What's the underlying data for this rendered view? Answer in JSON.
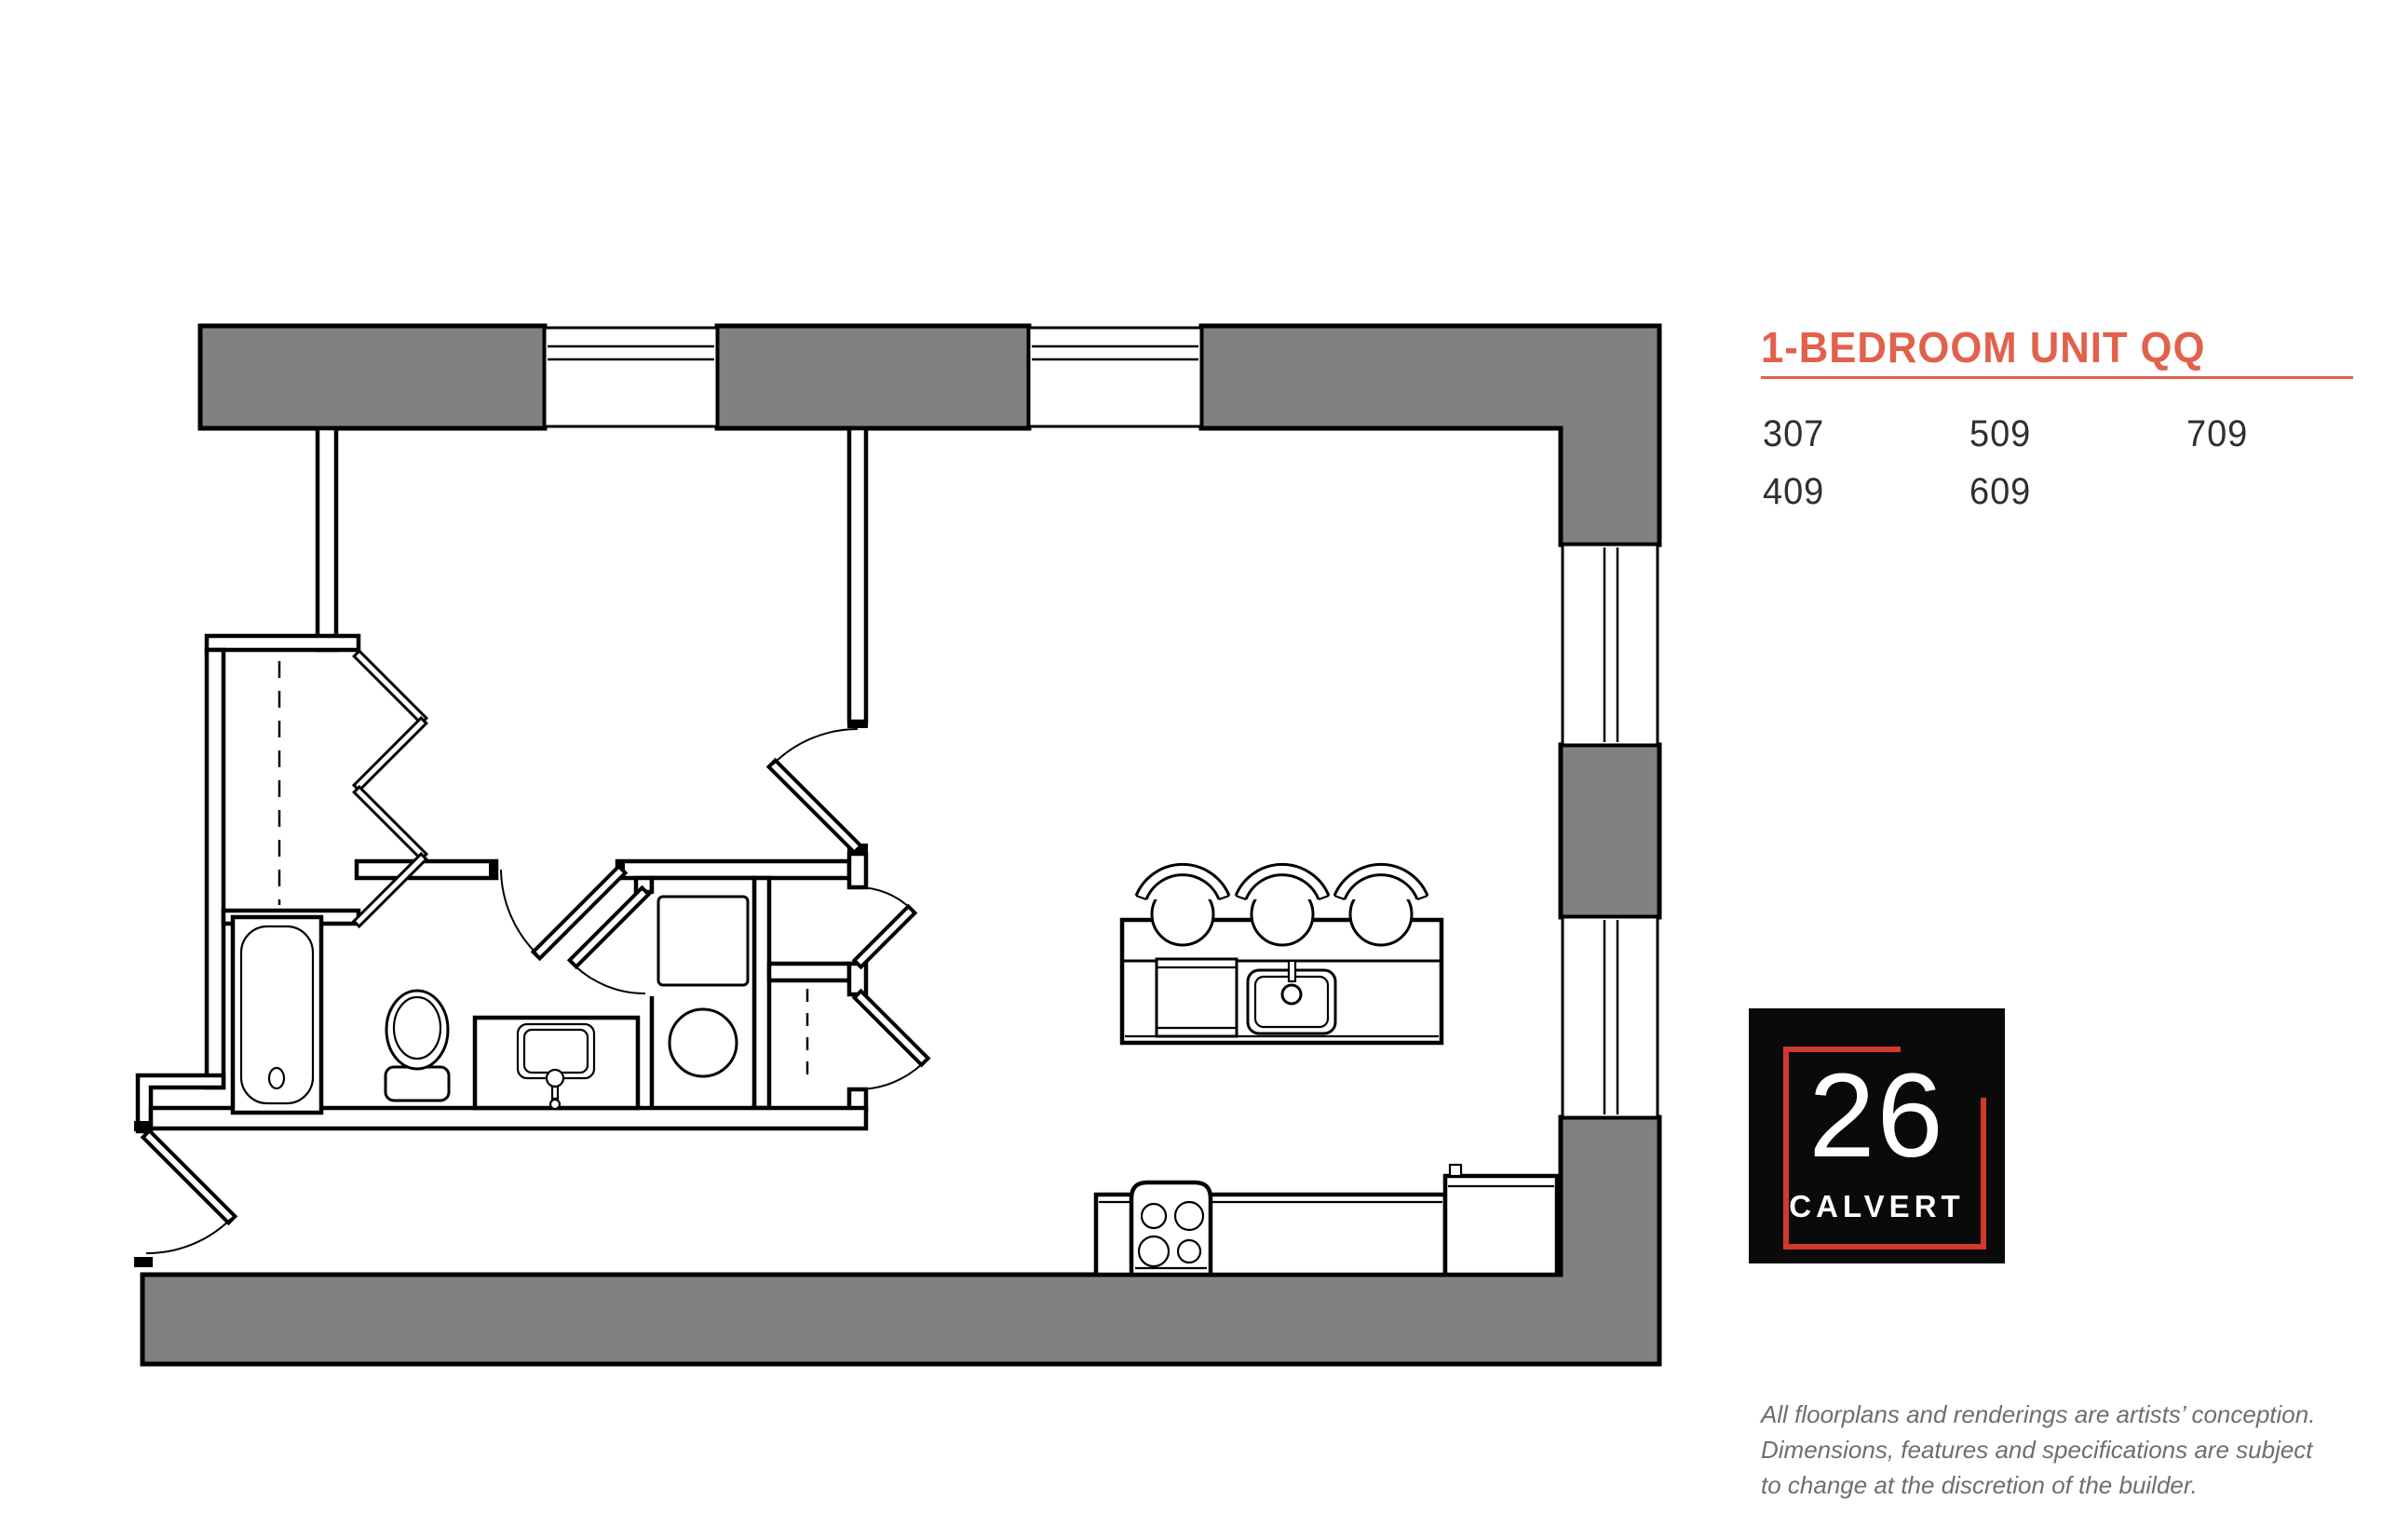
{
  "page_title": "1-Bedroom Unit QQ Floor Plan",
  "colors": {
    "accent": "#E2614C",
    "logo_red": "#D03A2B",
    "wall_gray": "#818181",
    "text_dark": "#2F2F2F",
    "muted_gray": "#6E6E6E"
  },
  "plan": {
    "title": "1-BEDROOM UNIT QQ",
    "units_row1": [
      "307",
      "509",
      "709"
    ],
    "units_row2": [
      "409",
      "609"
    ]
  },
  "logo": {
    "number": "26",
    "name": "CALVERT"
  },
  "disclaimer": {
    "line1": "All floorplans and renderings are artists’ conception.",
    "line2": "Dimensions, features and specifications are subject",
    "line3": "to change at the discretion of the builder."
  },
  "floorplan": {
    "rooms": [
      "bedroom",
      "bedroom-closet",
      "bathroom",
      "laundry-closet",
      "coat-closet",
      "linen-closet",
      "living-dining",
      "kitchen",
      "entry-vestibule"
    ],
    "fixtures": [
      "bathtub",
      "toilet",
      "vanity-sink",
      "stacked-washer-dryer",
      "kitchen-island",
      "bar-stools",
      "island-sink",
      "dishwasher",
      "range",
      "refrigerator"
    ],
    "doors": [
      "entry-door",
      "bedroom-door",
      "bathroom-door",
      "laundry-door",
      "coat-closet-door",
      "linen-closet-door",
      "bifold-closet-doors"
    ],
    "windows": [
      "top-wall-window-1",
      "top-wall-window-2",
      "right-wall-window-1",
      "right-wall-window-2"
    ]
  }
}
